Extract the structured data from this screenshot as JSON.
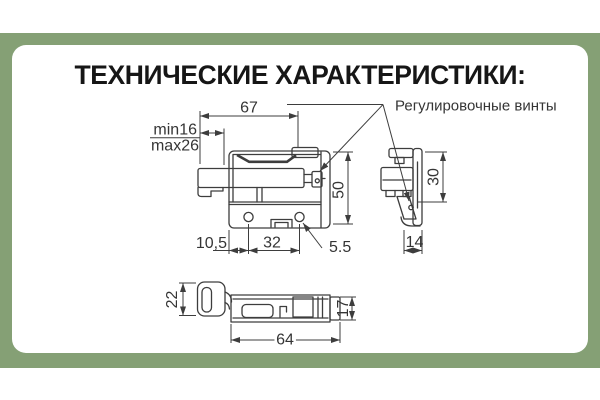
{
  "window": {
    "title": "ТЕХНИЧЕСКИЕ ХАРАКТЕРИСТИКИ:"
  },
  "annotation": {
    "adjustment_screws": "Регулировочные винты"
  },
  "dimensions": {
    "front": {
      "width": "67",
      "min": "min16",
      "max": "max26",
      "height": "50",
      "edge_to_hole": "10,5",
      "hole_spacing": "32",
      "hole_diameter": "5.5"
    },
    "side": {
      "height": "30",
      "depth": "14"
    },
    "bottom": {
      "hook_width": "22",
      "length": "64",
      "body_width": "17"
    }
  },
  "colors": {
    "background": "#ffffff",
    "band": "#85A075",
    "card": "#ffffff",
    "line": "#3d3d3d",
    "text": "#353535",
    "title": "#161616"
  }
}
